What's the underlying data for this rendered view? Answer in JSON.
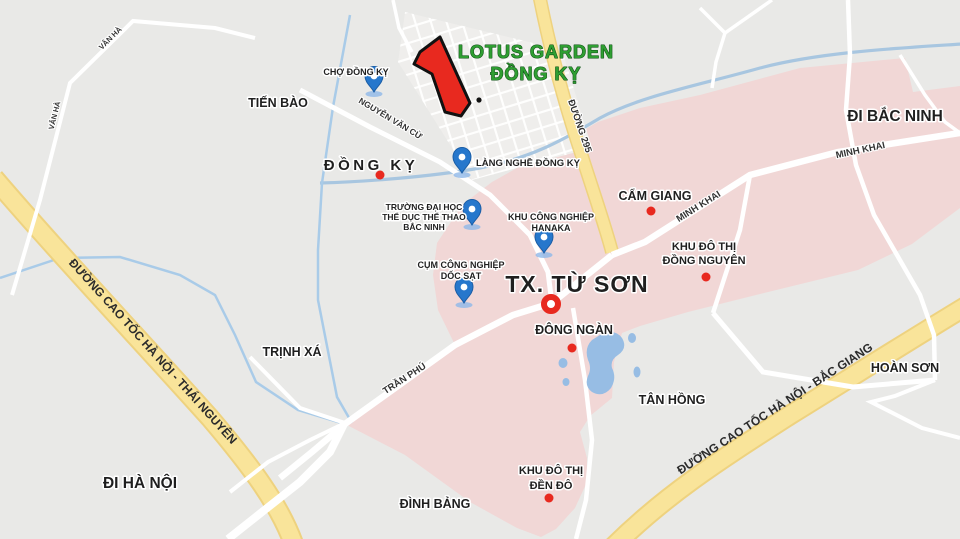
{
  "map_title": {
    "line1": "LOTUS GARDEN",
    "line2": "ĐỒNG KỴ"
  },
  "directions": {
    "bac_ninh": "ĐI BẮC NINH",
    "ha_noi": "ĐI HÀ NỘI"
  },
  "city": {
    "tu_son": "TX. TỪ SƠN"
  },
  "towns": {
    "tien_bao": "TIẾN BÀO",
    "dong_ky": "ĐỒNG KỴ",
    "trinh_xa": "TRỊNH XÁ",
    "dinh_bang": "ĐÌNH BẢNG",
    "tan_hong": "TÂN HỒNG",
    "hoan_son": "HOÀN SƠN",
    "cam_giang": "CẨM GIANG",
    "dong_ngan": "ĐÔNG NGÀN"
  },
  "urban_areas": {
    "dong_nguyen": [
      "KHU ĐÔ THỊ",
      "ĐỒNG NGUYÊN"
    ],
    "den_do": [
      "KHU ĐÔ THỊ",
      "ĐỀN ĐÔ"
    ]
  },
  "pois": {
    "cho_dong_ky": "CHỢ ĐỒNG KỴ",
    "lang_nghe_dong_ky": "LÀNG NGHỀ ĐỒNG KỴ",
    "university": [
      "TRƯỜNG ĐẠI HỌC",
      "THỂ DỤC THỂ THAO",
      "BẮC NINH"
    ],
    "hanaka": [
      "KHU CÔNG NGHIỆP",
      "HANAKA"
    ],
    "doc_sat": [
      "CỤM CÔNG NGHIỆP",
      "DỐC SẠT"
    ]
  },
  "roads": {
    "nguyen_van_cu": "NGUYỄN VĂN CỪ",
    "duong_295": "ĐƯỜNG 295",
    "minh_khai": "MINH KHAI",
    "tran_phu": "TRẦN PHÚ",
    "van_ha": "VÂN HÀ",
    "cao_toc_thai_nguyen": "ĐƯỜNG CAO TỐC HÀ NỘI - THÁI NGUYÊN",
    "cao_toc_bac_giang": "ĐƯỜNG CAO TỐC HÀ NỘI - BẮC GIANG"
  },
  "markers": {
    "red_polygon": "LOTUS GARDEN ĐỒNG KỴ",
    "red_ring": "TX. TỪ SƠN",
    "blue_pins": [
      "CHỢ ĐỒNG KỴ",
      "LÀNG NGHỀ ĐỒNG KỴ",
      "TRƯỜNG ĐẠI HỌC THỂ DỤC THỂ THAO BẮC NINH",
      "KHU CÔNG NGHIỆP HANAKA",
      "CỤM CÔNG NGHIỆP DỐC SẠT"
    ],
    "red_dots": [
      "ĐỒNG KỴ",
      "CẨM GIANG",
      "KHU ĐÔ THỊ ĐỒNG NGUYÊN",
      "ĐÔNG NGÀN",
      "KHU ĐÔ THỊ ĐỀN ĐÔ"
    ]
  },
  "colors": {
    "land": "#e9e9e7",
    "district_pink": "#f1d7d6",
    "highway_yellow": "#f9e49a",
    "highway_edge": "#eed27f",
    "road_white": "#ffffff",
    "water_blue": "#97bde4",
    "river_blue": "#a8c6e0",
    "pin_blue": "#2677cc",
    "marker_red": "#e8291f",
    "title_green": "#2f9e32",
    "label_dark": "#1f1f1f"
  }
}
